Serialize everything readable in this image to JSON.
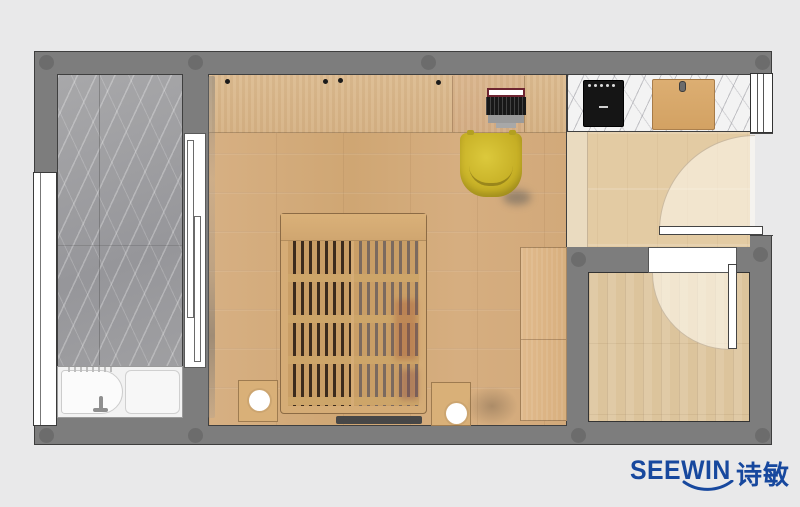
{
  "meta": {
    "kind": "interior floor plan rendering (top-down)"
  },
  "logo": {
    "latin": "SEEWIN",
    "chinese": "诗敏",
    "color": "#17489e"
  },
  "colors": {
    "background": "#e9e9ea",
    "wall": "#7d7d7d",
    "wall_outline": "#3e3e3e",
    "balcony_marble": "#a0a0a2",
    "kitchen_marble": "#f3f3f3",
    "bedroom_floor": "#d4ab7c",
    "hall_floor": "#e3cba3",
    "small_room_floor": "#dcc49c",
    "bed_wood": "#d5ac76",
    "chair_yellow": "#c9b227",
    "cooktop_black": "#151515",
    "tub_white": "#f2f2f2"
  },
  "legend": {
    "rooms": [
      "balcony-bathroom",
      "bedroom-studio",
      "kitchen-entry-hall",
      "small-room"
    ],
    "items": [
      "bathtub-shower",
      "sliding-glass-door",
      "desk-counter",
      "laptop",
      "yellow-chair",
      "platform-slat-bed",
      "nightstand-left",
      "nightstand-right",
      "round-lamp",
      "wardrobe",
      "induction-cooktop",
      "cutting-board",
      "entry-door-swing",
      "small-room-door-swing",
      "window-left",
      "window-right"
    ]
  }
}
